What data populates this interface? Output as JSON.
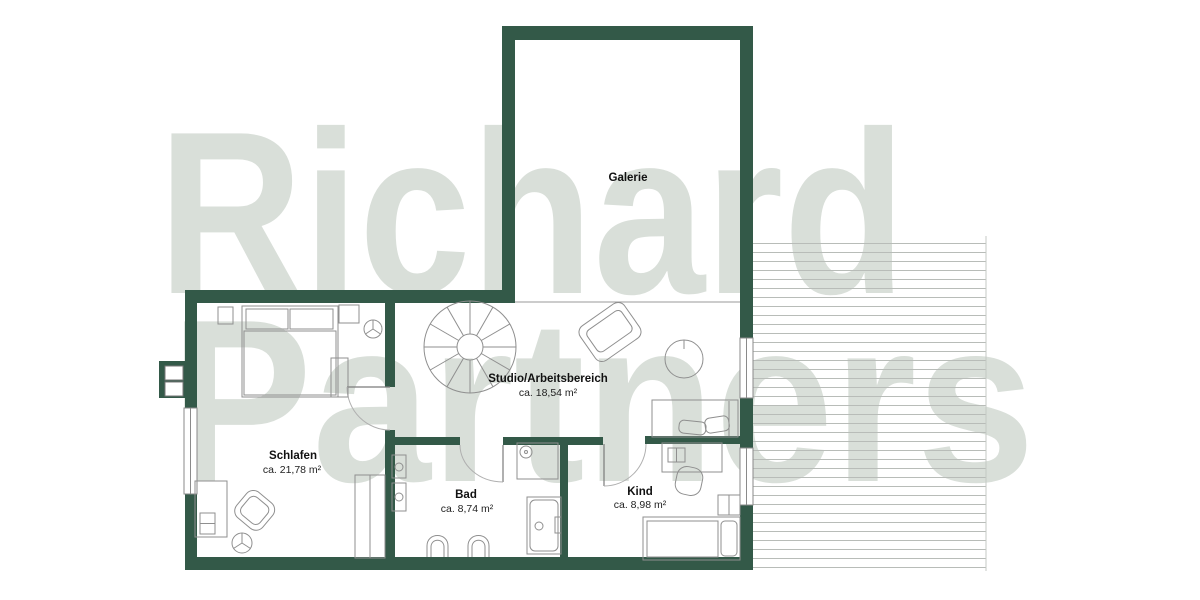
{
  "watermark": {
    "line1": "Richard",
    "line2": "Partners"
  },
  "rooms": {
    "galerie": {
      "name": "Galerie",
      "area": ""
    },
    "studio": {
      "name": "Studio/Arbeitsbereich",
      "area": "ca. 18,54 m²"
    },
    "schlafen": {
      "name": "Schlafen",
      "area": "ca. 21,78 m²"
    },
    "bad": {
      "name": "Bad",
      "area": "ca. 8,74 m²"
    },
    "kind": {
      "name": "Kind",
      "area": "ca. 8,98 m²"
    }
  },
  "colors": {
    "wall": "#335948",
    "furniture_line": "#8f8f8f",
    "watermark": "#d9dfd9",
    "decking_line": "#b8bcb8",
    "background": "#ffffff"
  },
  "legend": {
    "plan_type": "upper floor plan",
    "outdoor_area": "terrace decking (right side)"
  }
}
